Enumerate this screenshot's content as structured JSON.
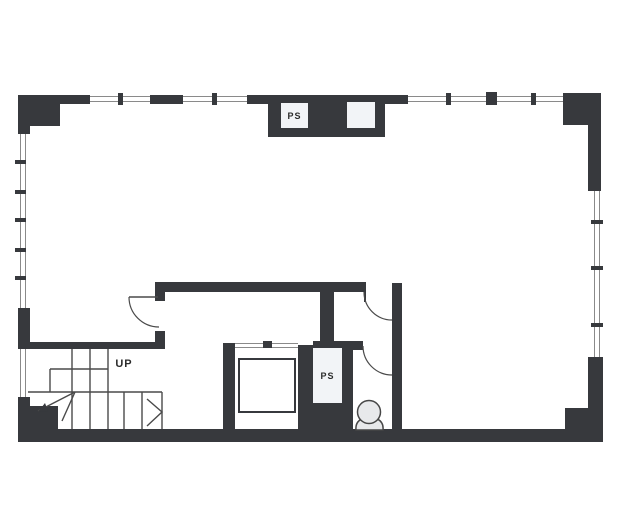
{
  "title": "floor-plan",
  "colors": {
    "paper": "#ffffff",
    "wall": "#37393d",
    "window_line": "#8a8a8a",
    "line": "#4a4a4a",
    "text": "#2b2b2b",
    "shaft_box_fill": "#f2f4f7",
    "fixture_fill": "#e8e9eb"
  },
  "labels": {
    "pipe_shaft_top": "PS",
    "pipe_shaft_lower": "PS",
    "stairs_direction": "UP"
  }
}
